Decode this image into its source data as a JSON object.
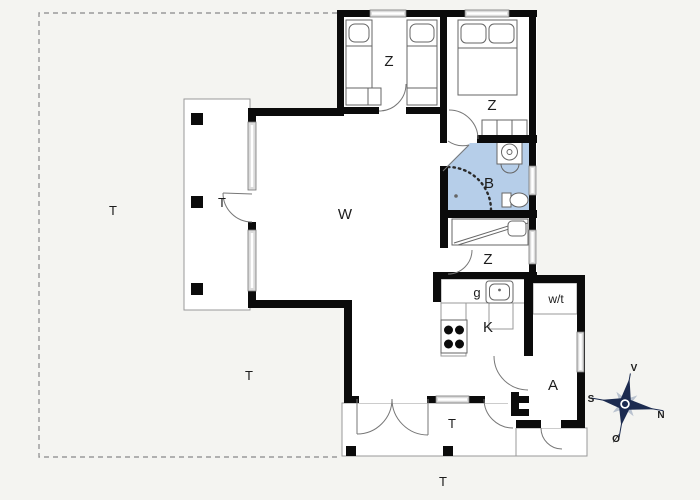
{
  "rooms": {
    "living": "W",
    "bedroom_left": "Z",
    "bedroom_right": "Z",
    "bedroom_small": "Z",
    "bathroom": "B",
    "kitchen": "K",
    "pantry": "g",
    "utility": "w/t",
    "annex": "A"
  },
  "terraces": {
    "west_deck": "T",
    "garden_west": "T",
    "garden_south": "T",
    "south_terrace": "T",
    "south_ground": "T"
  },
  "compass": {
    "west": "V",
    "south": "S",
    "north": "N",
    "east": "Ø"
  },
  "colors": {
    "wall": "#0b0b0b",
    "line": "#666666",
    "thin": "#999999",
    "bathroom": "#b6cee9",
    "compass": "#1c2b50",
    "label": "#1c1c1c",
    "background": "#f4f4f1",
    "window_fill": "#dcdcdc"
  }
}
